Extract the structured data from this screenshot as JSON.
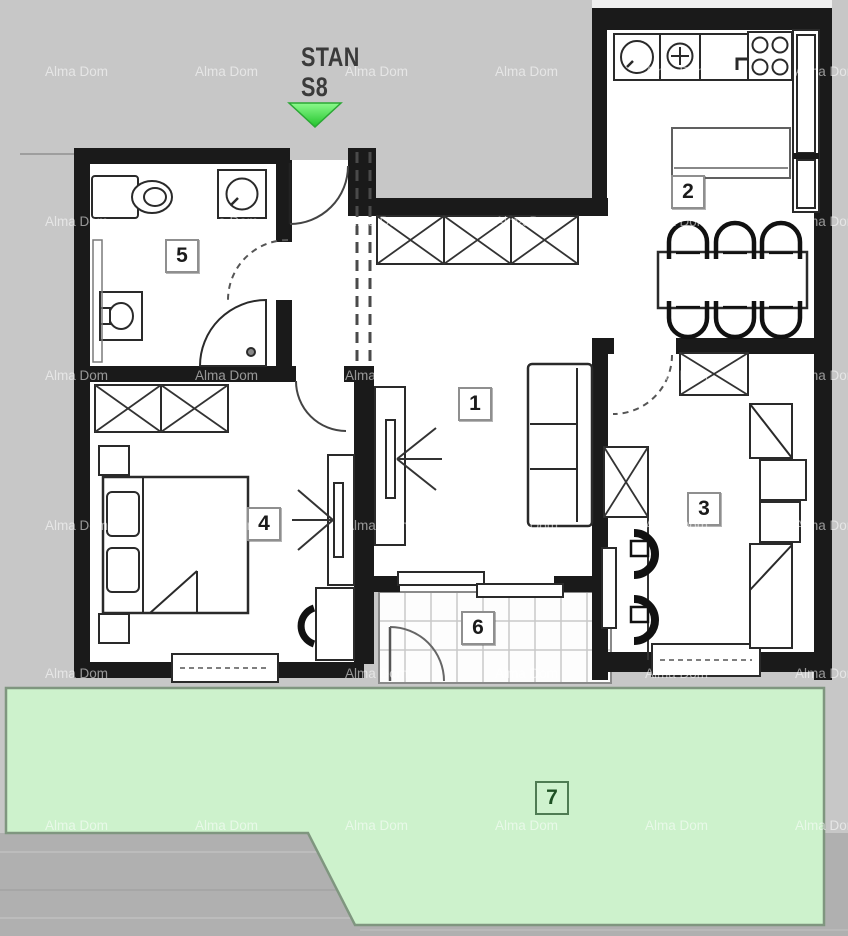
{
  "plan": {
    "title_line1": "STAN",
    "title_line2": "S8",
    "watermark_text": "Alma Dom",
    "rooms": [
      {
        "number": "1"
      },
      {
        "number": "2"
      },
      {
        "number": "3"
      },
      {
        "number": "4"
      },
      {
        "number": "5"
      },
      {
        "number": "6"
      },
      {
        "number": "7"
      }
    ],
    "colors": {
      "background": "#c7c7c7",
      "wall": "#1a1a1a",
      "garden_green": "#cdf2cc",
      "garden_border": "#7f967f",
      "arrow_green": "#45e24f",
      "watermark": "rgba(255,255,255,0.55)"
    }
  }
}
